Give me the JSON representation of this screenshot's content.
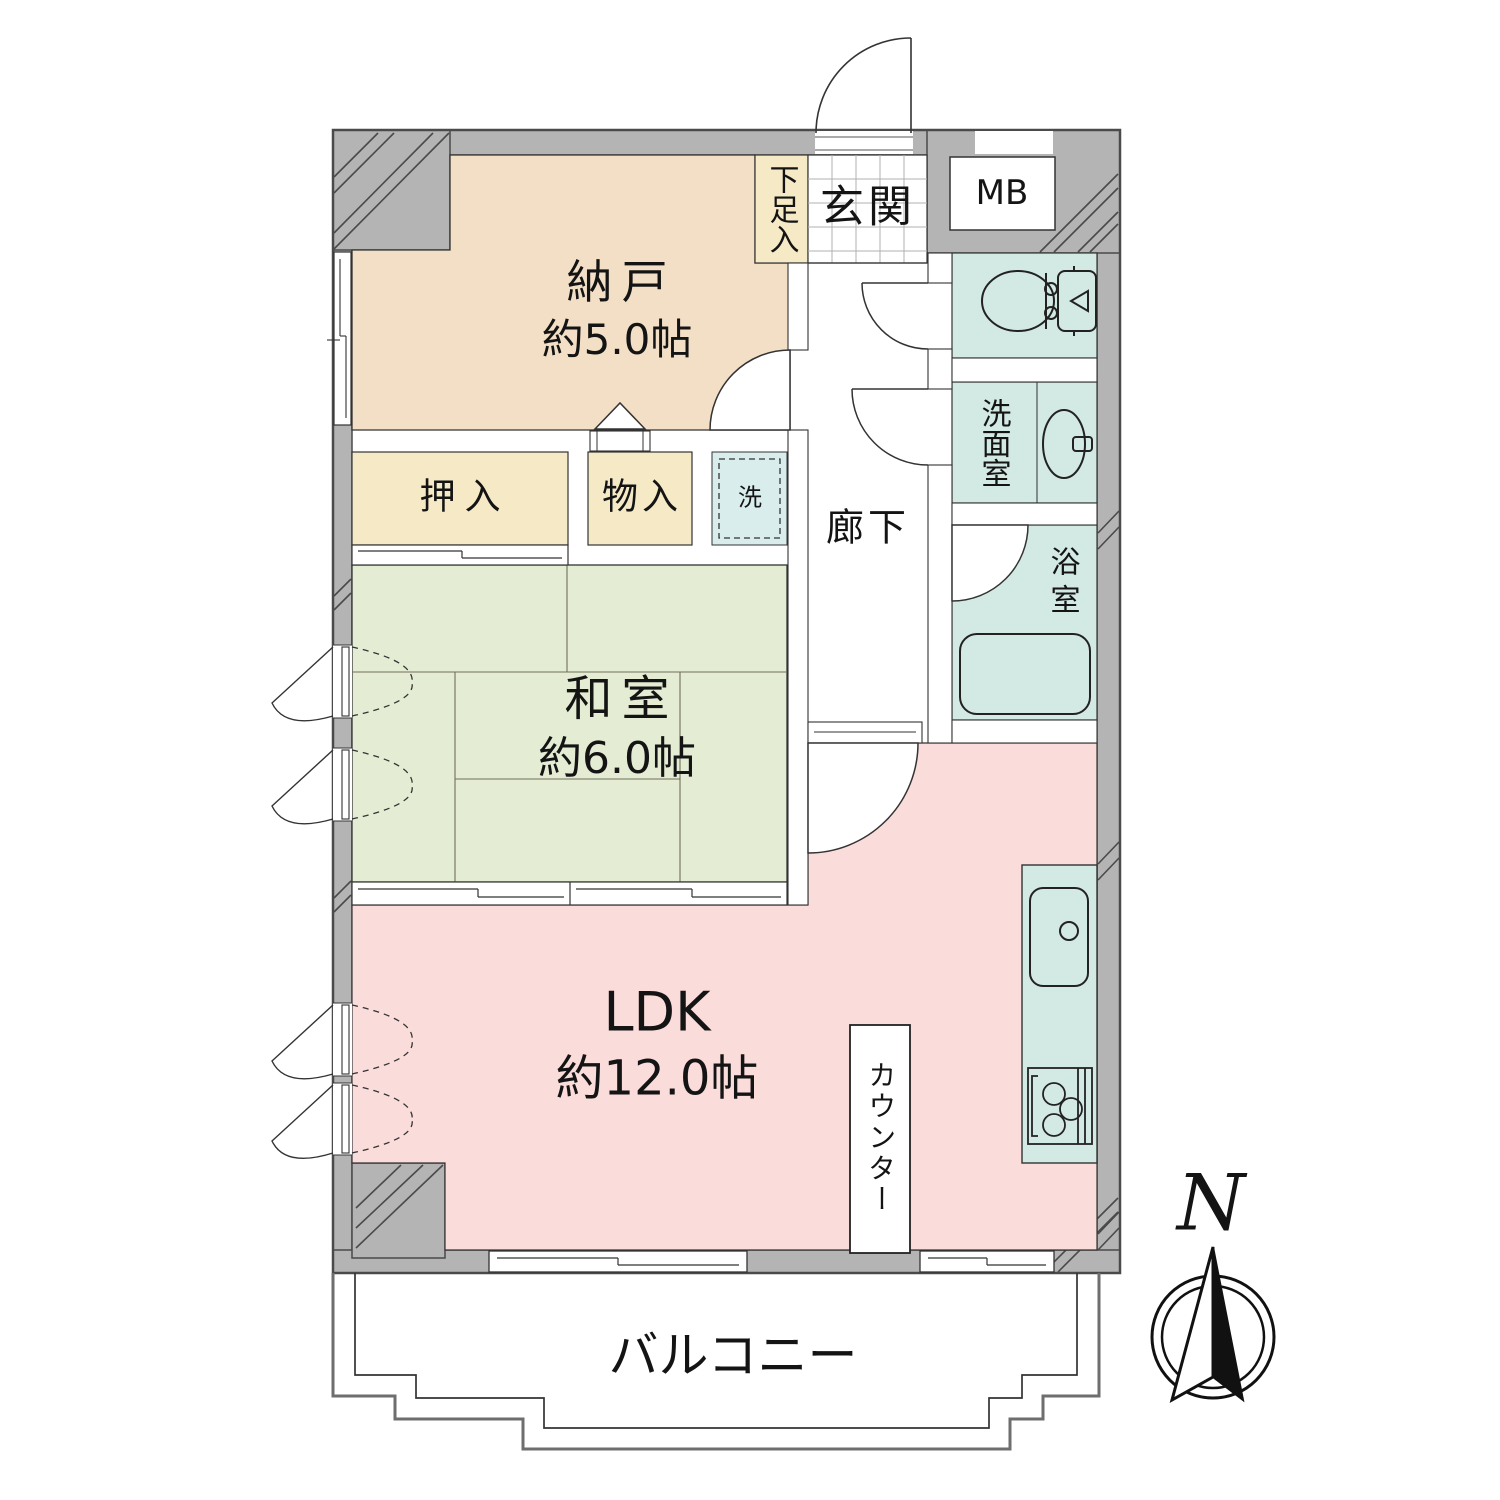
{
  "rooms": {
    "nando": {
      "name": "納戸",
      "size": "約5.0帖"
    },
    "washitsu": {
      "name": "和室",
      "size": "約6.0帖"
    },
    "ldk": {
      "name": "LDK",
      "size": "約12.0帖"
    },
    "balcony": {
      "name": "バルコニー"
    },
    "genkan": {
      "name": "玄関"
    },
    "rouka": {
      "name": "廊下"
    },
    "senmenshitsu": {
      "name": "洗面室"
    },
    "yokushitsu": {
      "name": "浴室"
    },
    "oshiire": {
      "name": "押入"
    },
    "monoire": {
      "name": "物入"
    },
    "getabako": {
      "name": "下足入"
    },
    "meter_box": {
      "name": "MB"
    },
    "counter": {
      "name": "カウンター"
    },
    "washer": {
      "name": "洗"
    }
  },
  "compass": {
    "north_label": "N"
  },
  "colors": {
    "wall": "#b4b4b4",
    "nando": "#f3dfc6",
    "closet": "#f6eac6",
    "washitsu": "#e4edd4",
    "ldk": "#fadcda",
    "wet": "#d3e9e3",
    "washer": "#d9eded"
  }
}
